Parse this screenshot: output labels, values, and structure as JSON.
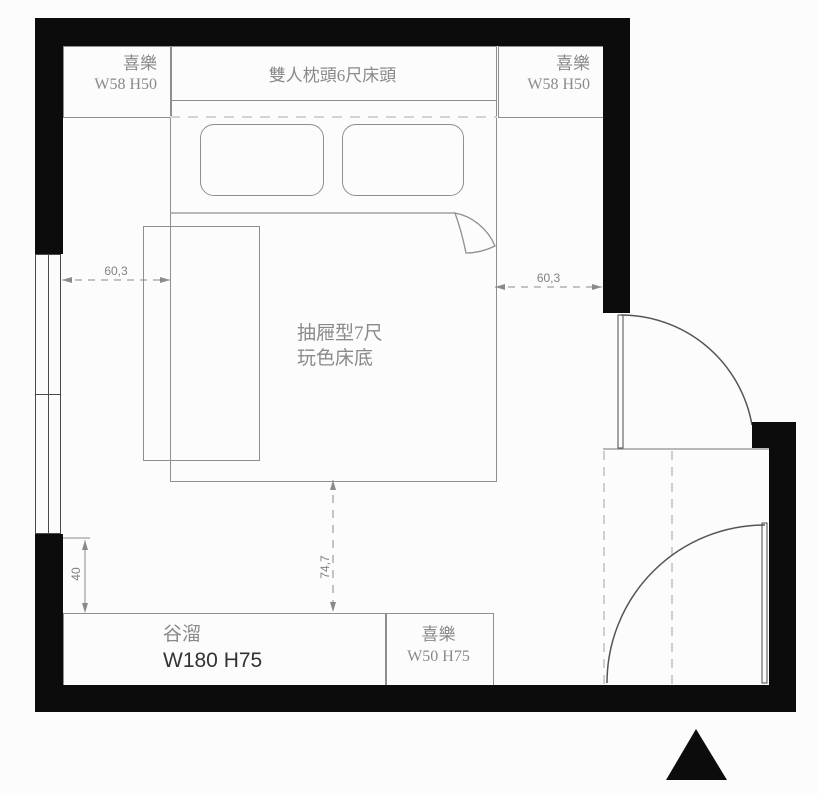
{
  "plan": {
    "headboard": {
      "label": "雙人枕頭6尺床頭"
    },
    "nightstand_left": {
      "name": "喜樂",
      "size": "W58 H50"
    },
    "nightstand_right": {
      "name": "喜樂",
      "size": "W58 H50"
    },
    "bed": {
      "line1": "抽屜型7尺",
      "line2": "玩色床底"
    },
    "cabinet_long": {
      "name": "谷溜",
      "size": "W180 H75"
    },
    "cabinet_small": {
      "name": "喜樂",
      "size": "W50 H75"
    },
    "dimensions": {
      "left_offset": "60,3",
      "right_offset": "60,3",
      "bottom_offset": "74,7",
      "side_offset": "40"
    },
    "colors": {
      "wall": "#0c0c0c",
      "furniture_line": "#8f8f8f",
      "dimension": "#818181",
      "background": "#fcfcfc",
      "bold_text": "#333333"
    }
  }
}
